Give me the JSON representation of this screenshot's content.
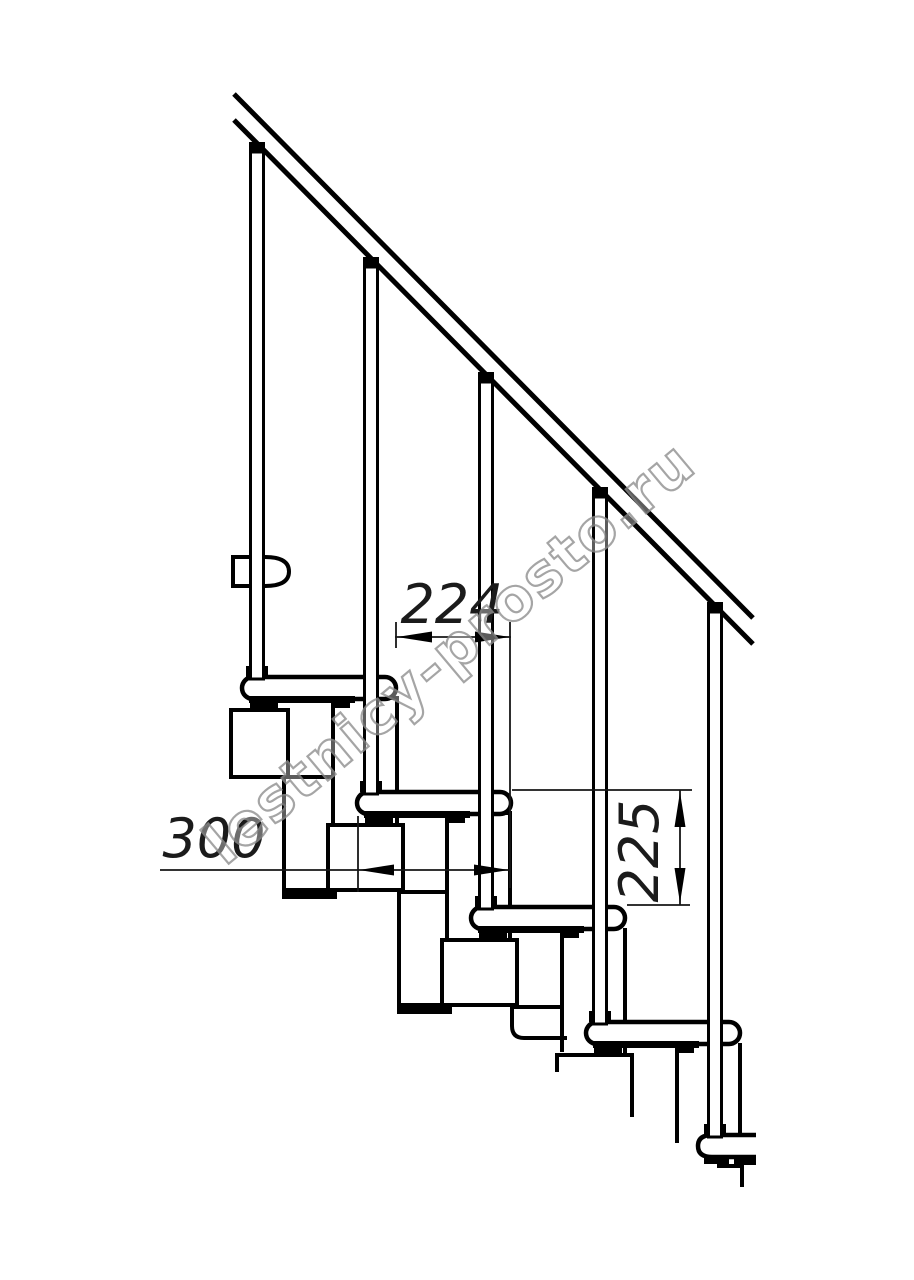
{
  "drawing": {
    "dimensions": {
      "run": "224",
      "depth": "300",
      "rise": "225"
    },
    "watermark": "lestnicy-prosto.ru",
    "colors": {
      "line": "#000000",
      "dim_line": "#161616",
      "watermark_stroke": "#8f8f8f",
      "background": "#ffffff"
    }
  }
}
